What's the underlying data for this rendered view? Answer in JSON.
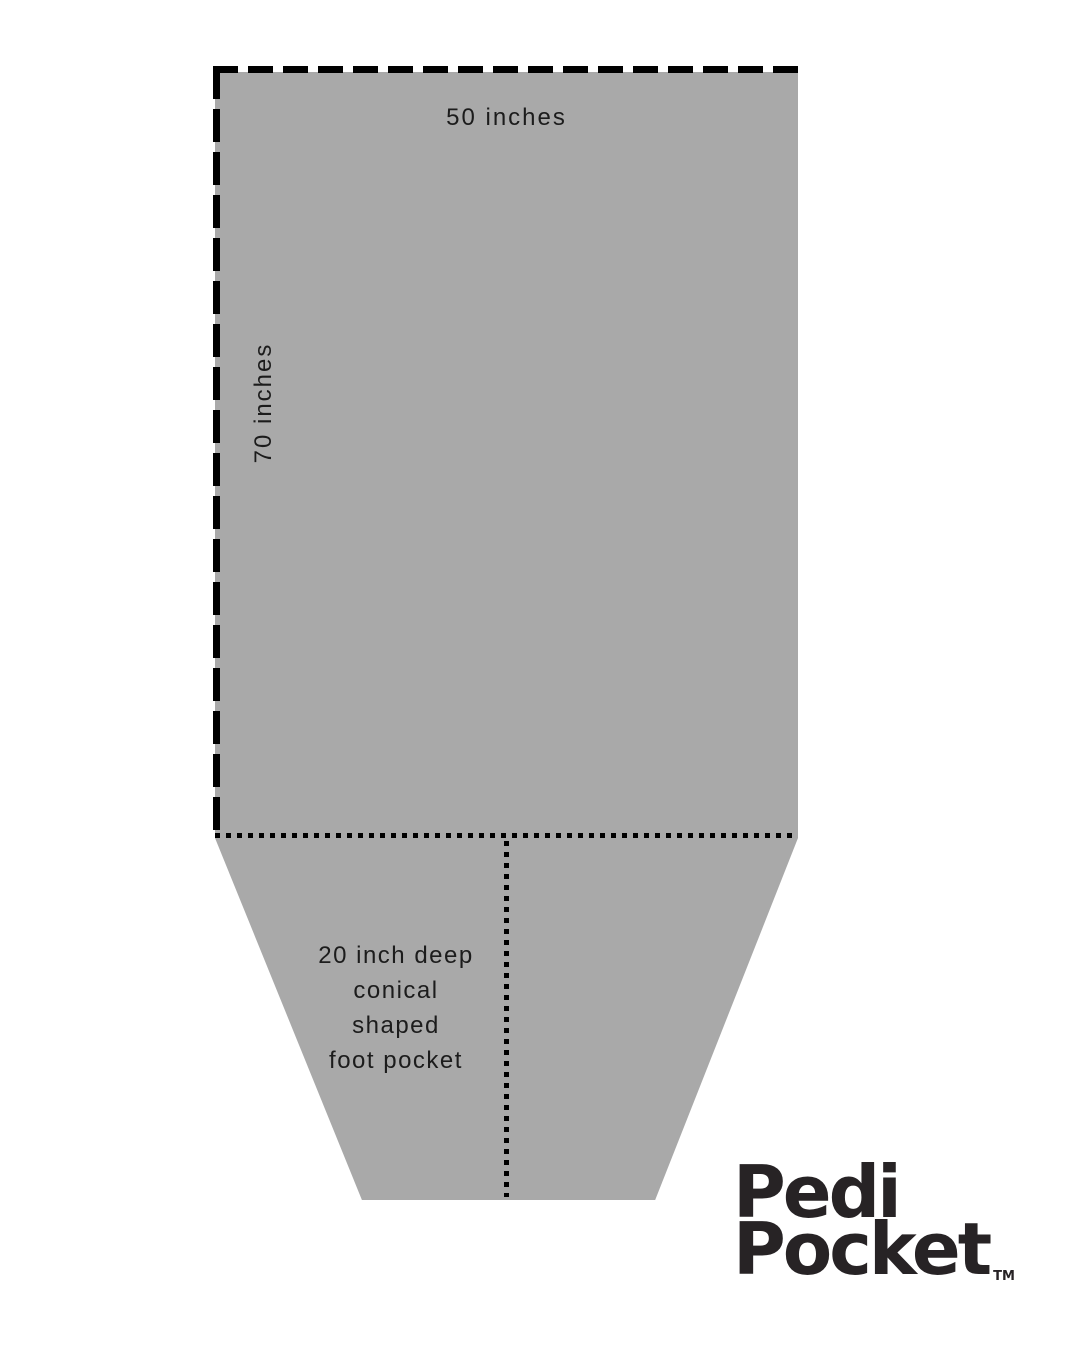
{
  "diagram": {
    "labels": {
      "width": "50 inches",
      "height": "70 inches",
      "pocket_lines": [
        "20 inch deep",
        "conical",
        "shaped",
        "foot pocket"
      ]
    },
    "logo": {
      "line1": "Pedi",
      "line2": "Pocket",
      "trademark": "TM"
    },
    "colors": {
      "bg": "#ffffff",
      "fabric": "#a9a9a9",
      "line": "#000000",
      "text": "#1c1c1c",
      "logo": "#272325"
    }
  }
}
